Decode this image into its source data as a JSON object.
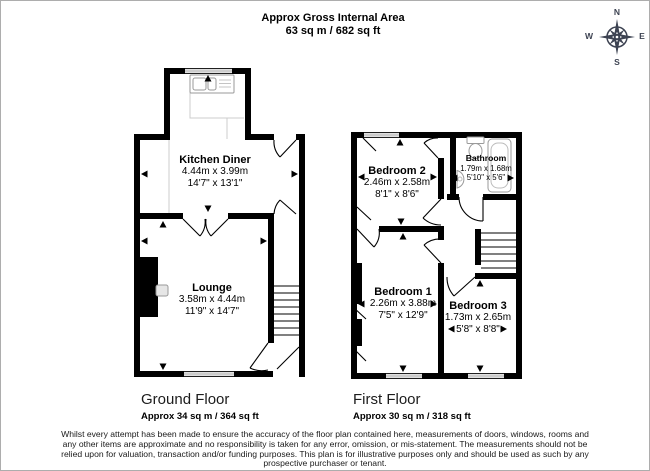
{
  "header": {
    "line1": "Approx Gross Internal Area",
    "line2": "63 sq m / 682 sq ft"
  },
  "compass": {
    "n": "N",
    "e": "E",
    "s": "S",
    "w": "W"
  },
  "ground_floor": {
    "title": "Ground Floor",
    "area": "Approx 34 sq m / 364 sq ft",
    "rooms": {
      "kitchen_diner": {
        "name": "Kitchen Diner",
        "metric": "4.44m x 3.99m",
        "imperial": "14'7\" x 13'1\""
      },
      "lounge": {
        "name": "Lounge",
        "metric": "3.58m x 4.44m",
        "imperial": "11'9\" x 14'7\""
      }
    }
  },
  "first_floor": {
    "title": "First Floor",
    "area": "Approx 30 sq m / 318 sq ft",
    "rooms": {
      "bedroom_2": {
        "name": "Bedroom 2",
        "metric": "2.46m x 2.58m",
        "imperial": "8'1\" x 8'6\""
      },
      "bathroom": {
        "name": "Bathroom",
        "metric": "1.79m x 1.68m",
        "imperial": "5'10\" x 5'6\""
      },
      "bedroom_1": {
        "name": "Bedroom 1",
        "metric": "2.26m x 3.88m",
        "imperial": "7'5\" x 12'9\""
      },
      "bedroom_3": {
        "name": "Bedroom 3",
        "metric": "1.73m x 2.65m",
        "imperial": "5'8\" x 8'8\""
      }
    }
  },
  "disclaimer": {
    "lines": [
      "Whilst every attempt has been made to ensure the accuracy of the floor plan contained here, measurements of doors, windows, rooms and",
      "any other items are approximate and no responsibility is taken for any error, omission, or mis-statement. The measurements should not be",
      "relied upon for valuation, transaction and/or funding purposes. This plan is for illustrative purposes only and should be used as such by any",
      "prospective purchaser or tenant."
    ]
  }
}
